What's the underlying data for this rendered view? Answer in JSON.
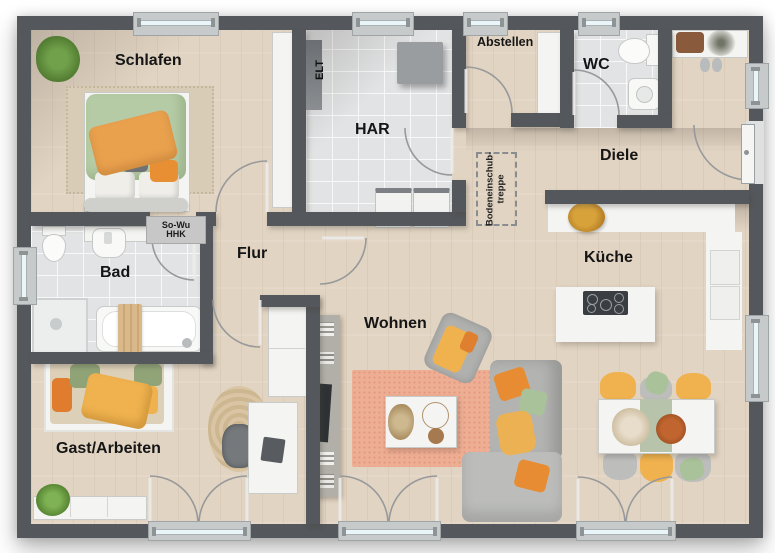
{
  "rooms": {
    "schlafen": "Schlafen",
    "har": "HAR",
    "abstellen": "Abstellen",
    "wc": "WC",
    "diele": "Diele",
    "flur": "Flur",
    "bad": "Bad",
    "kueche": "Küche",
    "wohnen": "Wohnen",
    "gast_arbeiten": "Gast/Arbeiten"
  },
  "annotations": {
    "elt": "ELT",
    "heating_unit_line1": "So-Wu",
    "heating_unit_line2": "HHK",
    "loft_ladder_line1": "Bodeneinschub-",
    "loft_ladder_line2": "treppe"
  },
  "colors": {
    "wall": "#54575b",
    "wood-floor": "#e2d4c2",
    "tile-floor": "#e2e3e4",
    "window-glass": "#eaf5f9",
    "accent-orange": "#e9a14e",
    "accent-green": "#a9c29a",
    "accent-yellow": "#efb24f",
    "rug-pink": "#eeae94",
    "furniture-white": "#f4f4f2",
    "furniture-gray": "#b7b8b6"
  }
}
